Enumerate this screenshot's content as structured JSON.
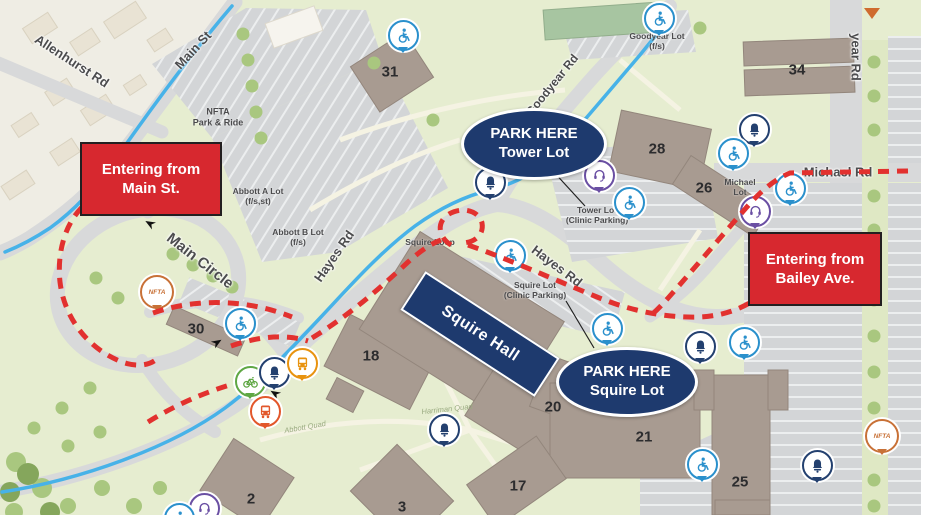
{
  "colors": {
    "campus_green": "#e6edd0",
    "offmap_beige": "#efede4",
    "road_gray": "#d8d9da",
    "building_brown": "#a89b91",
    "route_red": "#e2312f",
    "callout_red": "#d7282f",
    "navy": "#1e3a6e",
    "road_blue": "#47b2e8",
    "accessibility_blue": "#2a90cc",
    "bus_orange": "#e8930f",
    "shuttle_orange": "#e2572b",
    "bike_green": "#5fa744",
    "phone_purple": "#6a4fa3",
    "nfta_orange": "#c87137"
  },
  "callouts": {
    "entering_main": {
      "line1": "Entering from",
      "line2": "Main St."
    },
    "entering_bailey": {
      "line1": "Entering from",
      "line2": "Bailey Ave."
    },
    "park_here_tower": {
      "line1": "PARK HERE",
      "line2": "Tower Lot"
    },
    "park_here_squire": {
      "line1": "PARK HERE",
      "line2": "Squire Lot"
    },
    "squire_hall": {
      "label": "Squire Hall"
    }
  },
  "street_labels": [
    {
      "name": "allenhurst-rd",
      "text": "Allenhurst Rd",
      "x": 72,
      "y": 61,
      "rot": 33,
      "size": 13
    },
    {
      "name": "main-st",
      "text": "Main St",
      "x": 193,
      "y": 50,
      "rot": -47,
      "size": 13
    },
    {
      "name": "main-circle",
      "text": "Main Circle",
      "x": 200,
      "y": 261,
      "rot": 38,
      "size": 15
    },
    {
      "name": "hayes-rd-west",
      "text": "Hayes Rd",
      "x": 334,
      "y": 256,
      "rot": -55,
      "size": 13
    },
    {
      "name": "hayes-rd-east",
      "text": "Hayes Rd",
      "x": 557,
      "y": 266,
      "rot": 37,
      "size": 13
    },
    {
      "name": "goodyear-rd",
      "text": "Goodyear Rd",
      "x": 552,
      "y": 85,
      "rot": -51,
      "size": 12
    },
    {
      "name": "goodyear-rd-north",
      "text": "year Rd",
      "x": 856,
      "y": 57,
      "rot": 90,
      "size": 13
    },
    {
      "name": "michael-rd",
      "text": "Michael Rd",
      "x": 838,
      "y": 172,
      "rot": 0,
      "size": 13
    }
  ],
  "lot_labels": [
    {
      "name": "nfta-park-and-ride",
      "lines": [
        "NFTA",
        "Park & Ride"
      ],
      "x": 218,
      "y": 117,
      "size": 9
    },
    {
      "name": "abbott-a-lot",
      "lines": [
        "Abbott A Lot",
        "(f/s,st)"
      ],
      "x": 258,
      "y": 196,
      "size": 8.5
    },
    {
      "name": "abbott-b-lot",
      "lines": [
        "Abbott B Lot",
        "(f/s)"
      ],
      "x": 298,
      "y": 237,
      "size": 8.5
    },
    {
      "name": "squire-loop",
      "lines": [
        "Squire Loop"
      ],
      "x": 430,
      "y": 242,
      "size": 8.5
    },
    {
      "name": "tower-lot",
      "lines": [
        "Tower Lot",
        "(Clinic Parking)"
      ],
      "x": 597,
      "y": 215,
      "size": 8.5
    },
    {
      "name": "squire-lot",
      "lines": [
        "Squire Lot",
        "(Clinic Parking)"
      ],
      "x": 535,
      "y": 290,
      "size": 8.5
    },
    {
      "name": "goodyear-lot",
      "lines": [
        "Goodyear Lot",
        "(f/s)"
      ],
      "x": 657,
      "y": 41,
      "size": 8.5
    },
    {
      "name": "michael-lot",
      "lines": [
        "Michael",
        "Lot"
      ],
      "x": 740,
      "y": 187,
      "size": 8.5
    }
  ],
  "quad_labels": [
    {
      "name": "quad-label-west",
      "text": "Abbott Quad",
      "x": 305,
      "y": 427,
      "rot": -10
    },
    {
      "name": "quad-label-central",
      "text": "Harriman Quad",
      "x": 447,
      "y": 409,
      "rot": -6
    }
  ],
  "building_numbers": [
    {
      "n": "31",
      "x": 390,
      "y": 72
    },
    {
      "n": "34",
      "x": 797,
      "y": 70
    },
    {
      "n": "28",
      "x": 657,
      "y": 149
    },
    {
      "n": "26",
      "x": 704,
      "y": 188
    },
    {
      "n": "30",
      "x": 196,
      "y": 329
    },
    {
      "n": "18",
      "x": 371,
      "y": 356
    },
    {
      "n": "20",
      "x": 553,
      "y": 407
    },
    {
      "n": "21",
      "x": 644,
      "y": 437
    },
    {
      "n": "17",
      "x": 518,
      "y": 486
    },
    {
      "n": "25",
      "x": 740,
      "y": 482
    },
    {
      "n": "2",
      "x": 251,
      "y": 499
    },
    {
      "n": "3",
      "x": 402,
      "y": 507
    }
  ],
  "markers": [
    {
      "type": "accessibility",
      "name": "accessible-parking-icon",
      "x": 401,
      "y": 33
    },
    {
      "type": "accessibility",
      "name": "accessible-parking-icon",
      "x": 657,
      "y": 16
    },
    {
      "type": "bell",
      "name": "emergency-bell-icon",
      "x": 752,
      "y": 127
    },
    {
      "type": "accessibility",
      "name": "accessible-parking-icon",
      "x": 731,
      "y": 151
    },
    {
      "type": "accessibility",
      "name": "accessible-parking-icon",
      "x": 788,
      "y": 186
    },
    {
      "type": "phone",
      "name": "emergency-phone-icon",
      "x": 753,
      "y": 209
    },
    {
      "type": "phone",
      "name": "emergency-phone-icon",
      "x": 597,
      "y": 173
    },
    {
      "type": "accessibility",
      "name": "accessible-parking-icon",
      "x": 627,
      "y": 200
    },
    {
      "type": "bell",
      "name": "emergency-bell-icon",
      "x": 488,
      "y": 180
    },
    {
      "type": "accessibility",
      "name": "accessible-parking-icon",
      "x": 508,
      "y": 253
    },
    {
      "type": "accessibility",
      "name": "accessible-parking-icon",
      "x": 605,
      "y": 326
    },
    {
      "type": "bell",
      "name": "emergency-bell-icon",
      "x": 698,
      "y": 344
    },
    {
      "type": "accessibility",
      "name": "accessible-parking-icon",
      "x": 742,
      "y": 340
    },
    {
      "type": "accessibility",
      "name": "accessible-parking-icon",
      "x": 700,
      "y": 462
    },
    {
      "type": "bell",
      "name": "emergency-bell-icon",
      "x": 815,
      "y": 463
    },
    {
      "type": "nfta",
      "name": "nfta-stop-marker",
      "label": "NFTA",
      "x": 880,
      "y": 434
    },
    {
      "type": "nfta",
      "name": "nfta-stop-marker",
      "label": "NFTA",
      "x": 155,
      "y": 290
    },
    {
      "type": "accessibility",
      "name": "accessible-parking-icon",
      "x": 238,
      "y": 321
    },
    {
      "type": "bike",
      "name": "bike-rack-icon",
      "x": 248,
      "y": 379
    },
    {
      "type": "bell",
      "name": "emergency-bell-icon",
      "x": 272,
      "y": 370
    },
    {
      "type": "bus",
      "name": "bus-stop-icon",
      "x": 300,
      "y": 361
    },
    {
      "type": "shuttle",
      "name": "shuttle-stop-icon",
      "x": 263,
      "y": 409
    },
    {
      "type": "bell",
      "name": "emergency-bell-icon",
      "x": 442,
      "y": 427
    },
    {
      "type": "phone",
      "name": "emergency-phone-icon",
      "x": 202,
      "y": 506
    },
    {
      "type": "accessibility",
      "name": "accessible-parking-icon",
      "x": 177,
      "y": 516
    },
    {
      "type": "chevron",
      "name": "marker-tip-icon",
      "x": 872,
      "y": 8
    }
  ]
}
